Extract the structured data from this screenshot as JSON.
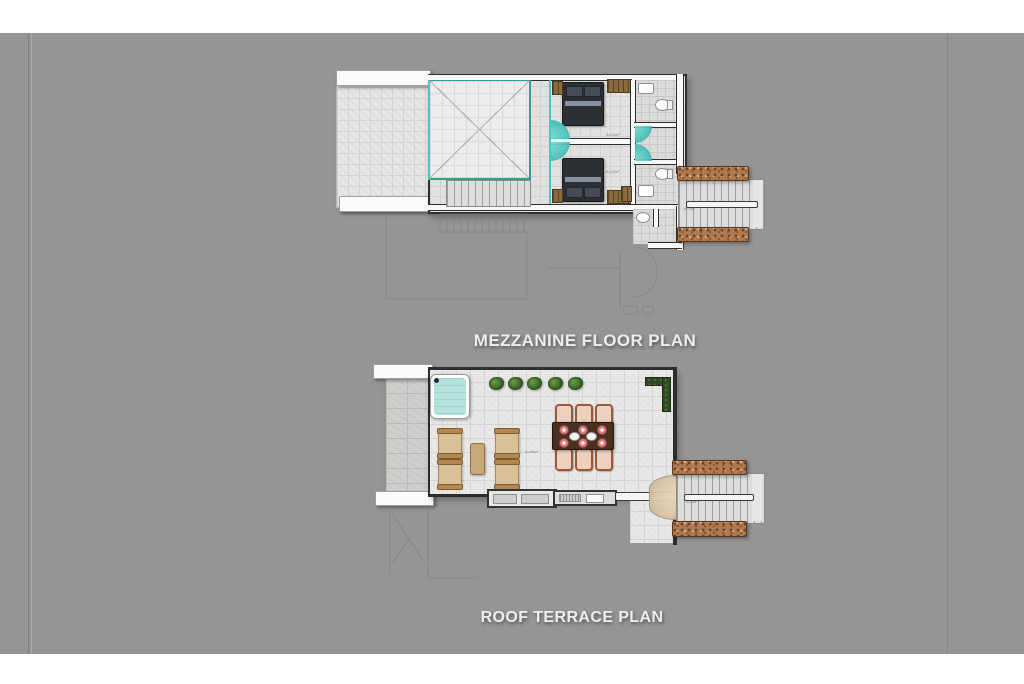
{
  "document": {
    "type": "architectural-floor-plan-sheet",
    "background_color": "#959595"
  },
  "plans": [
    {
      "label": "MEZZANINE FLOOR PLAN",
      "area_labels": {
        "bedroom_1": "A=12m²",
        "bedroom_2": "A=12m²",
        "stair": "A=4m²"
      },
      "features": [
        "open-tiled-terrace",
        "planter-bars",
        "double-height-void",
        "internal-stair",
        "glass-partition",
        "bedroom-1-double-bed",
        "bedroom-2-double-bed",
        "wardrobes",
        "bathroom-top",
        "bathroom-bottom",
        "shower-doors",
        "external-stone-staircase",
        "lower-floor-ghost-outline"
      ]
    },
    {
      "label": "ROOF TERRACE PLAN",
      "area_labels": {
        "terrace": "A=40m²",
        "stair": "A=4m²"
      },
      "features": [
        "jacuzzi",
        "planter-bars",
        "potted-plants",
        "l-shaped-planter",
        "lounge-chairs",
        "coffee-table",
        "dining-table-6-seats",
        "outdoor-kitchen-counter",
        "stair-door-arc",
        "external-stone-staircase",
        "lower-floor-ghost-outline"
      ]
    }
  ],
  "colors": {
    "background": "#959595",
    "teal": "#4fc3bd",
    "stone": "#b1794f",
    "table": "#4a3020",
    "cushion": "#d9c096",
    "water": "#b5e2dc",
    "label": "#ededed"
  }
}
